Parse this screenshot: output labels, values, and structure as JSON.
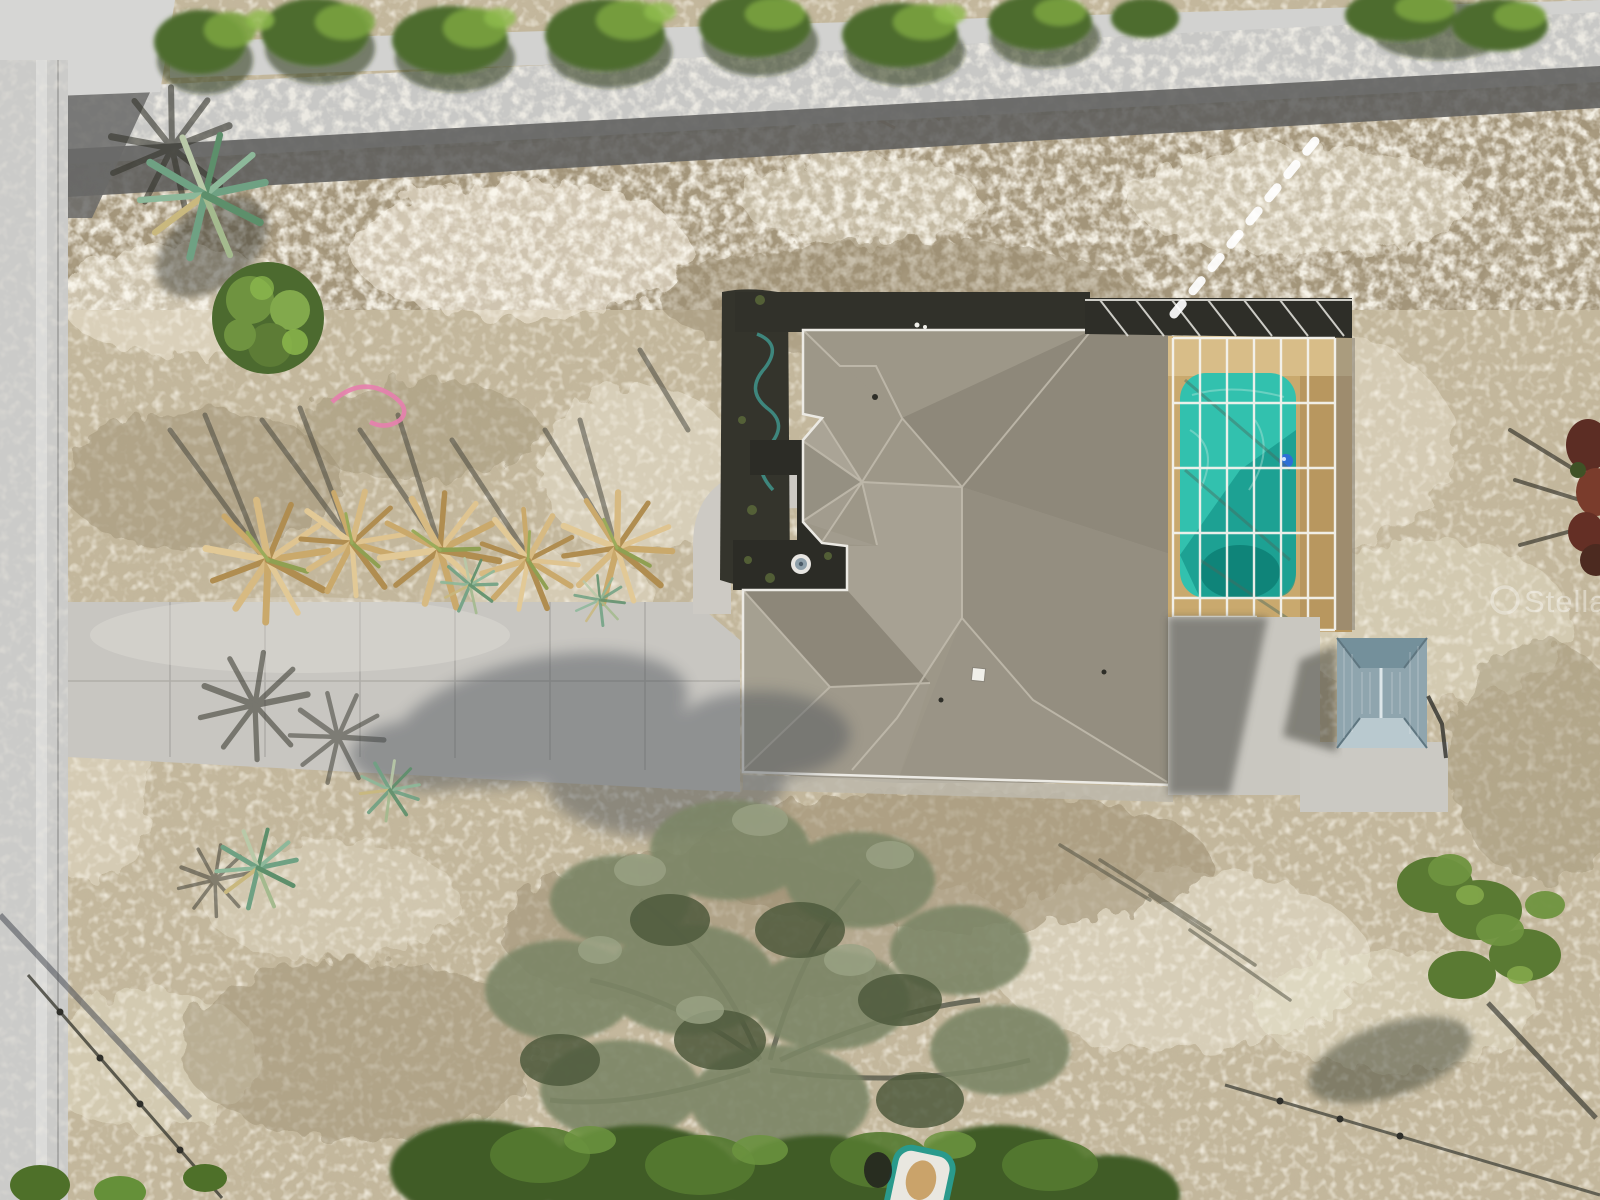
{
  "scene": {
    "type_label": "aerial-drone-photo",
    "description": "Overhead aerial view of a single-family home with a screened pool enclosure, long concrete driveway, dried palms and a large oak on a sandy scrub lot bordered by two roads",
    "watermark": {
      "text": "StellarMLS"
    },
    "colors": {
      "sand": "#c3b79c",
      "sand_white": "#ece5d3",
      "scrub": "#a3957a",
      "road_light": "#c8c8c6",
      "road_dark": "#5f5f5d",
      "side_road": "#cbcbc9",
      "driveway": "#c8c6c1",
      "roof": "#9d9788",
      "roof_light": "#a8a294",
      "roof_dark": "#8e887a",
      "gutter": "#eceae4",
      "pool": "#32c1ae",
      "pool_deep": "#0d7f74",
      "deck_tan": "#c9a96e",
      "cage_white": "#f4f3ee",
      "screen_dark": "#2e2e28",
      "gazebo_roof": "#8fa5ae",
      "pad_concrete": "#c9c7c0",
      "tree_green": "#4e6c2e",
      "tree_green_light": "#79a23f",
      "palm_tan": "#caa96b",
      "palm_teal": "#6fa183",
      "oak_olive": "#7c8666",
      "shadow": "#3a3a30",
      "float_blue": "#2e6fd6",
      "hose_pink": "#e77fae"
    },
    "features": [
      {
        "name": "side-road",
        "label": "street along left edge"
      },
      {
        "name": "top-road",
        "label": "street along top edge"
      },
      {
        "name": "driveway",
        "label": "concrete driveway"
      },
      {
        "name": "front-walkway",
        "label": "curved entry walkway"
      },
      {
        "name": "fountain",
        "label": "round courtyard fountain"
      },
      {
        "name": "house-roof",
        "label": "gray hip shingle roof"
      },
      {
        "name": "pool-enclosure",
        "label": "white screened pool cage"
      },
      {
        "name": "swimming-pool",
        "label": "teal swimming pool"
      },
      {
        "name": "pool-float",
        "label": "blue pool float"
      },
      {
        "name": "gazebo",
        "label": "metal-roof gazebo"
      },
      {
        "name": "palm-row",
        "label": "row of dried palms"
      },
      {
        "name": "oak-tree",
        "label": "large oak canopy"
      },
      {
        "name": "boat",
        "label": "small boat under trees"
      },
      {
        "name": "survey-dashes",
        "label": "white dashed line to street"
      }
    ]
  }
}
